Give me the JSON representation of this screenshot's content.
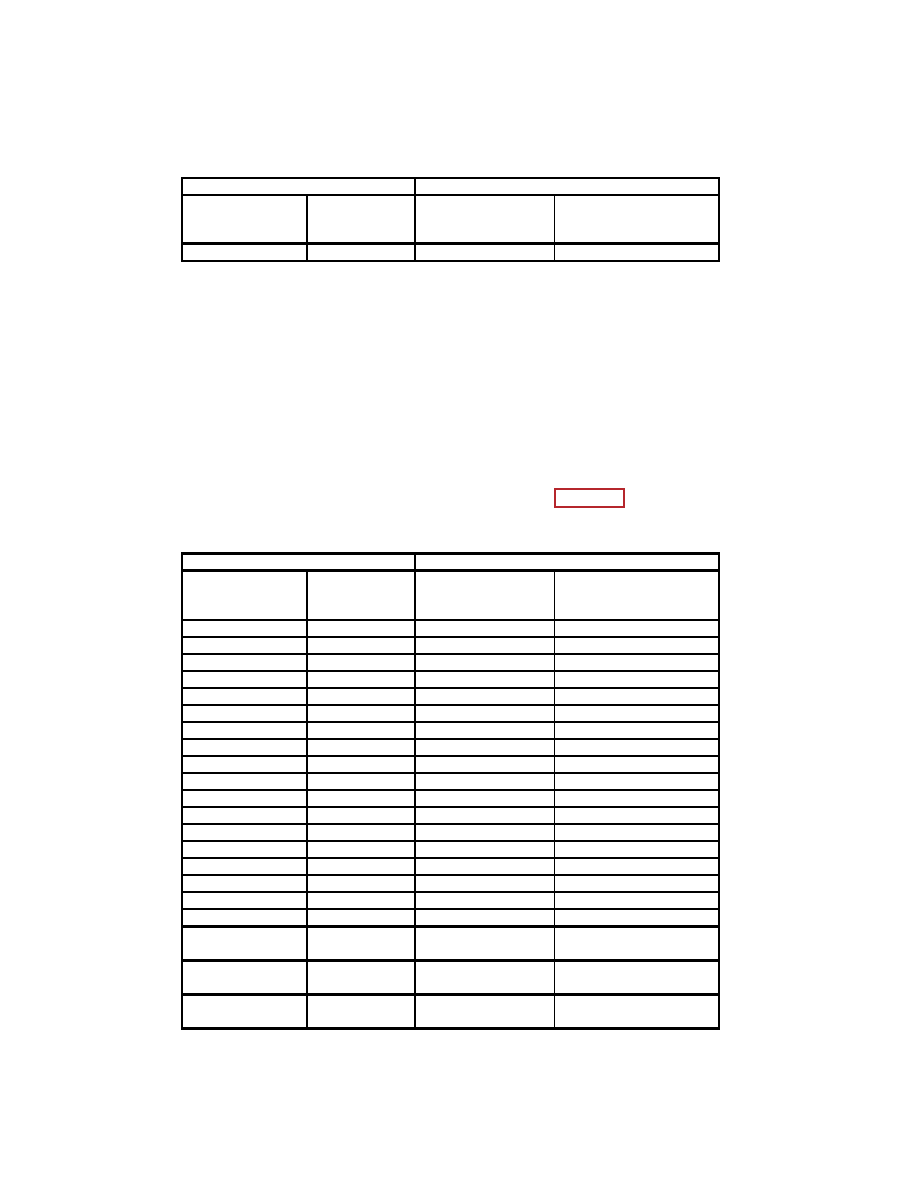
{
  "page": {
    "type": "scanned-document-page",
    "background": "#FFFFFF",
    "visible_text": ""
  },
  "colors": {
    "table_border": "#000000",
    "link_box_border": "#B5262C"
  },
  "upper_table": {
    "columns": 4,
    "column_widths_px": [
      125,
      108,
      139,
      165
    ],
    "header_band": {
      "left_label": "",
      "right_label": ""
    },
    "header_row_labels": [
      "",
      "",
      "",
      ""
    ],
    "body_rows": 1,
    "all_cells_empty": true
  },
  "lower_table": {
    "columns": 4,
    "column_widths_px": [
      125,
      108,
      139,
      165
    ],
    "header_band": {
      "left_label": "",
      "right_label": ""
    },
    "header_row_labels": [
      "",
      "",
      "",
      ""
    ],
    "thin_body_rows": 18,
    "tall_bottom_rows": 3,
    "all_cells_empty": true
  },
  "link_annotation": {
    "label": ""
  }
}
